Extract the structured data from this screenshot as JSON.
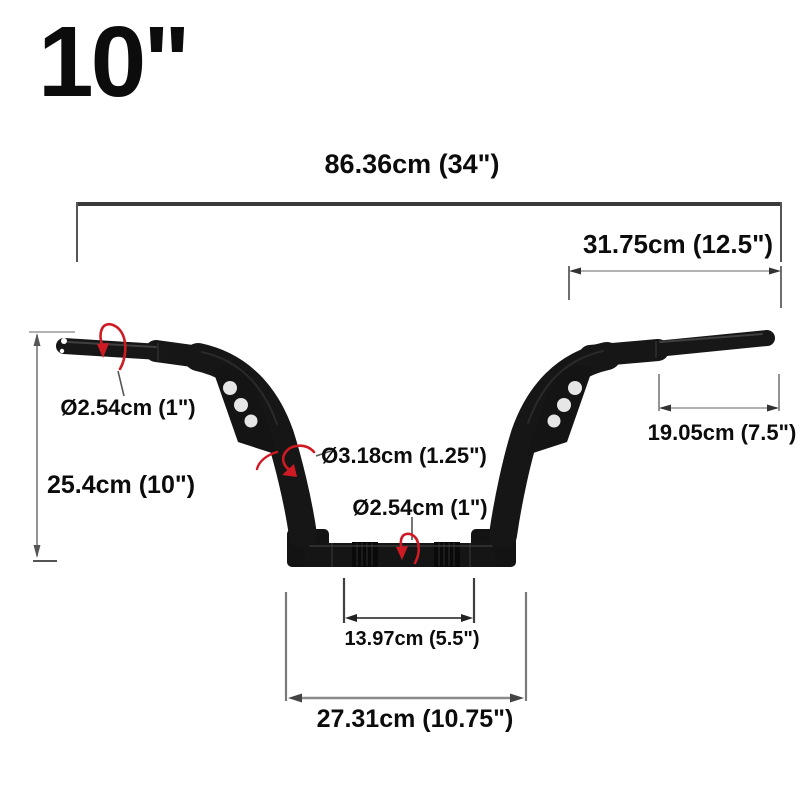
{
  "product": {
    "rise_size": "10\"",
    "dimensions": {
      "overall_width": "86.36cm (34\")",
      "top_width": "31.75cm (12.5\")",
      "left_grip_diameter": "Ø2.54cm (1\")",
      "rise_height": "25.4cm (10\")",
      "riser_diameter": "Ø3.18cm (1.25\")",
      "center_diameter": "Ø2.54cm (1\")",
      "clamp_width": "13.97cm (5.5\")",
      "base_width": "27.31cm (10.75\")",
      "right_grip_length": "19.05cm (7.5\")"
    },
    "annotations": {
      "rotation_arrow_left_grip": "tube-diameter rotation arrow (left grip)",
      "rotation_arrow_riser": "tube-diameter rotation arrow (left riser)",
      "rotation_arrow_center": "tube-diameter rotation arrow (center bar)"
    }
  },
  "colors": {
    "background": "#ffffff",
    "text": "#0c0c0c",
    "handlebar": "#161616",
    "dimension_lines": "#6f6f6f",
    "rotation_arrow": "#ce1b23",
    "gusset_hole": "#e6e6e6"
  }
}
